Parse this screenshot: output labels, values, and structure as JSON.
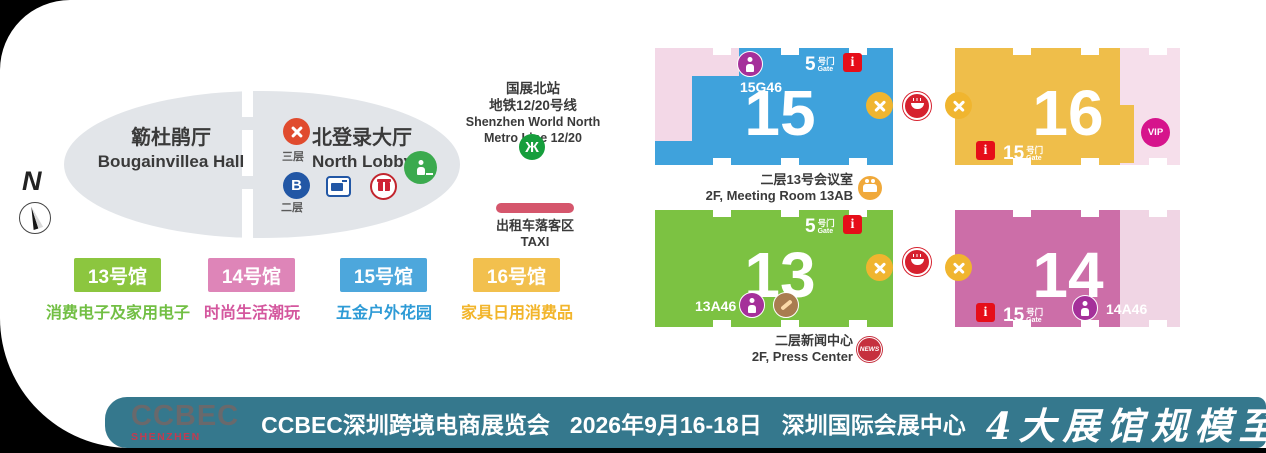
{
  "compass": {
    "n": "N"
  },
  "overview": {
    "bougainvillea_zh": "簕杜鹃厅",
    "bougainvillea_en": "Bougainvillea Hall",
    "lobby_zh": "北登录大厅",
    "lobby_en": "North Lobby",
    "floor3": "三层",
    "floor2": "二层",
    "b_badge": "B",
    "metro_station_zh": "国展北站",
    "metro_line_zh": "地铁12/20号线",
    "metro_station_en": "Shenzhen World North",
    "metro_line_en": "Metro Line 12/20",
    "metro_logo_glyph": "Ж",
    "taxi_zh": "出租车落客区",
    "taxi_en": "TAXI"
  },
  "legend": {
    "items": [
      {
        "chip": "13号馆",
        "desc": "消费电子及家用电子"
      },
      {
        "chip": "14号馆",
        "desc": "时尚生活潮玩"
      },
      {
        "chip": "15号馆",
        "desc": "五金户外花园"
      },
      {
        "chip": "16号馆",
        "desc": "家具日用消费品"
      }
    ]
  },
  "halls": {
    "h15": {
      "number": "15",
      "booth": "15G46",
      "gate_num": "5",
      "gate_zh": "号门",
      "gate_en": "Gate",
      "info": "i"
    },
    "h16": {
      "number": "16",
      "gate_num": "15",
      "gate_zh": "号门",
      "gate_en": "Gate",
      "info": "i",
      "vip": "VIP"
    },
    "h13": {
      "number": "13",
      "booth": "13A46",
      "gate_num": "5",
      "gate_zh": "号门",
      "gate_en": "Gate",
      "info": "i"
    },
    "h14": {
      "number": "14",
      "booth": "14A46",
      "gate_num": "15",
      "gate_zh": "号门",
      "gate_en": "Gate",
      "info": "i"
    }
  },
  "notes": {
    "meeting_zh": "二层13号会议室",
    "meeting_en": "2F, Meeting Room 13AB",
    "press_zh": "二层新闻中心",
    "press_en": "2F, Press Center",
    "news_badge": "NEWS"
  },
  "banner": {
    "logo_top": "CCBEC",
    "logo_bottom": "SHENZHEN",
    "title": "CCBEC深圳跨境电商展览会",
    "date": "2026年9月16-18日",
    "venue": "深圳国际会展中心",
    "slogan": "4大展馆规模至大"
  },
  "colors": {
    "hall13_green": "#7CC242",
    "hall14_pink": "#CC6EA8",
    "hall15_blue": "#3FA2DC",
    "hall16_yellow": "#EFBE4A",
    "light_pink": "#F3D8E7",
    "banner_teal": "#35788D",
    "metro_green": "#169E3C",
    "taxi_red": "#D5566C",
    "info_red": "#E60E19",
    "nursing_purple": "#A5309A",
    "vip_magenta": "#D6148C",
    "dining_yellow": "#F0B52F",
    "food_red": "#D6212E"
  }
}
